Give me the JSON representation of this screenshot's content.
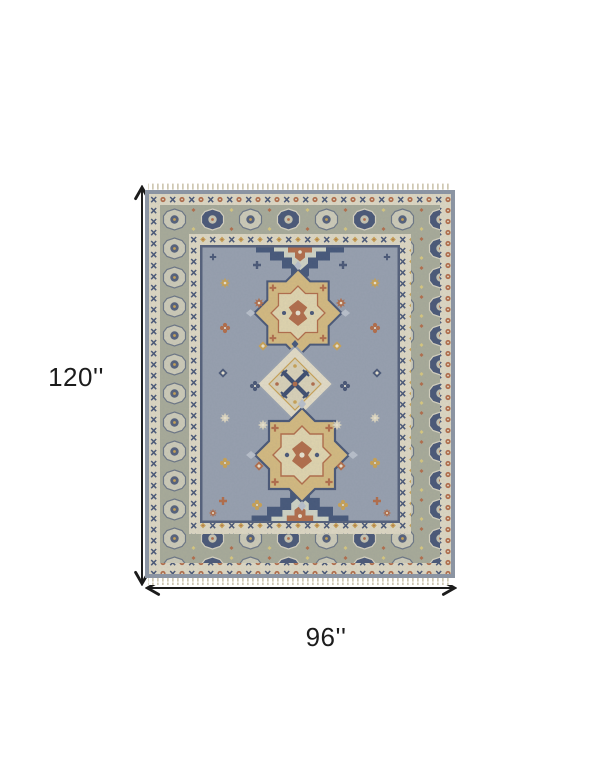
{
  "diagram": {
    "height_label": "120''",
    "width_label": "96''"
  },
  "icons": {
    "vertical_arrow": "double-headed-vertical-arrow",
    "horizontal_arrow": "double-headed-horizontal-arrow"
  },
  "colors": {
    "background": "#ffffff",
    "dimension_lines": "#1c1c1c",
    "label_text": "#1c1c1c",
    "rug_field": "#97a0af",
    "rug_edge": "#8d96a4",
    "rug_guard_border": "#ded8c3",
    "rug_main_border": "#a8ab99",
    "rug_navy": "#46587a",
    "rug_gold": "#cfa85c",
    "rug_rust": "#b26d4a",
    "rug_cream": "#e3dcc6",
    "rug_fringe": "#cfc8b2"
  }
}
